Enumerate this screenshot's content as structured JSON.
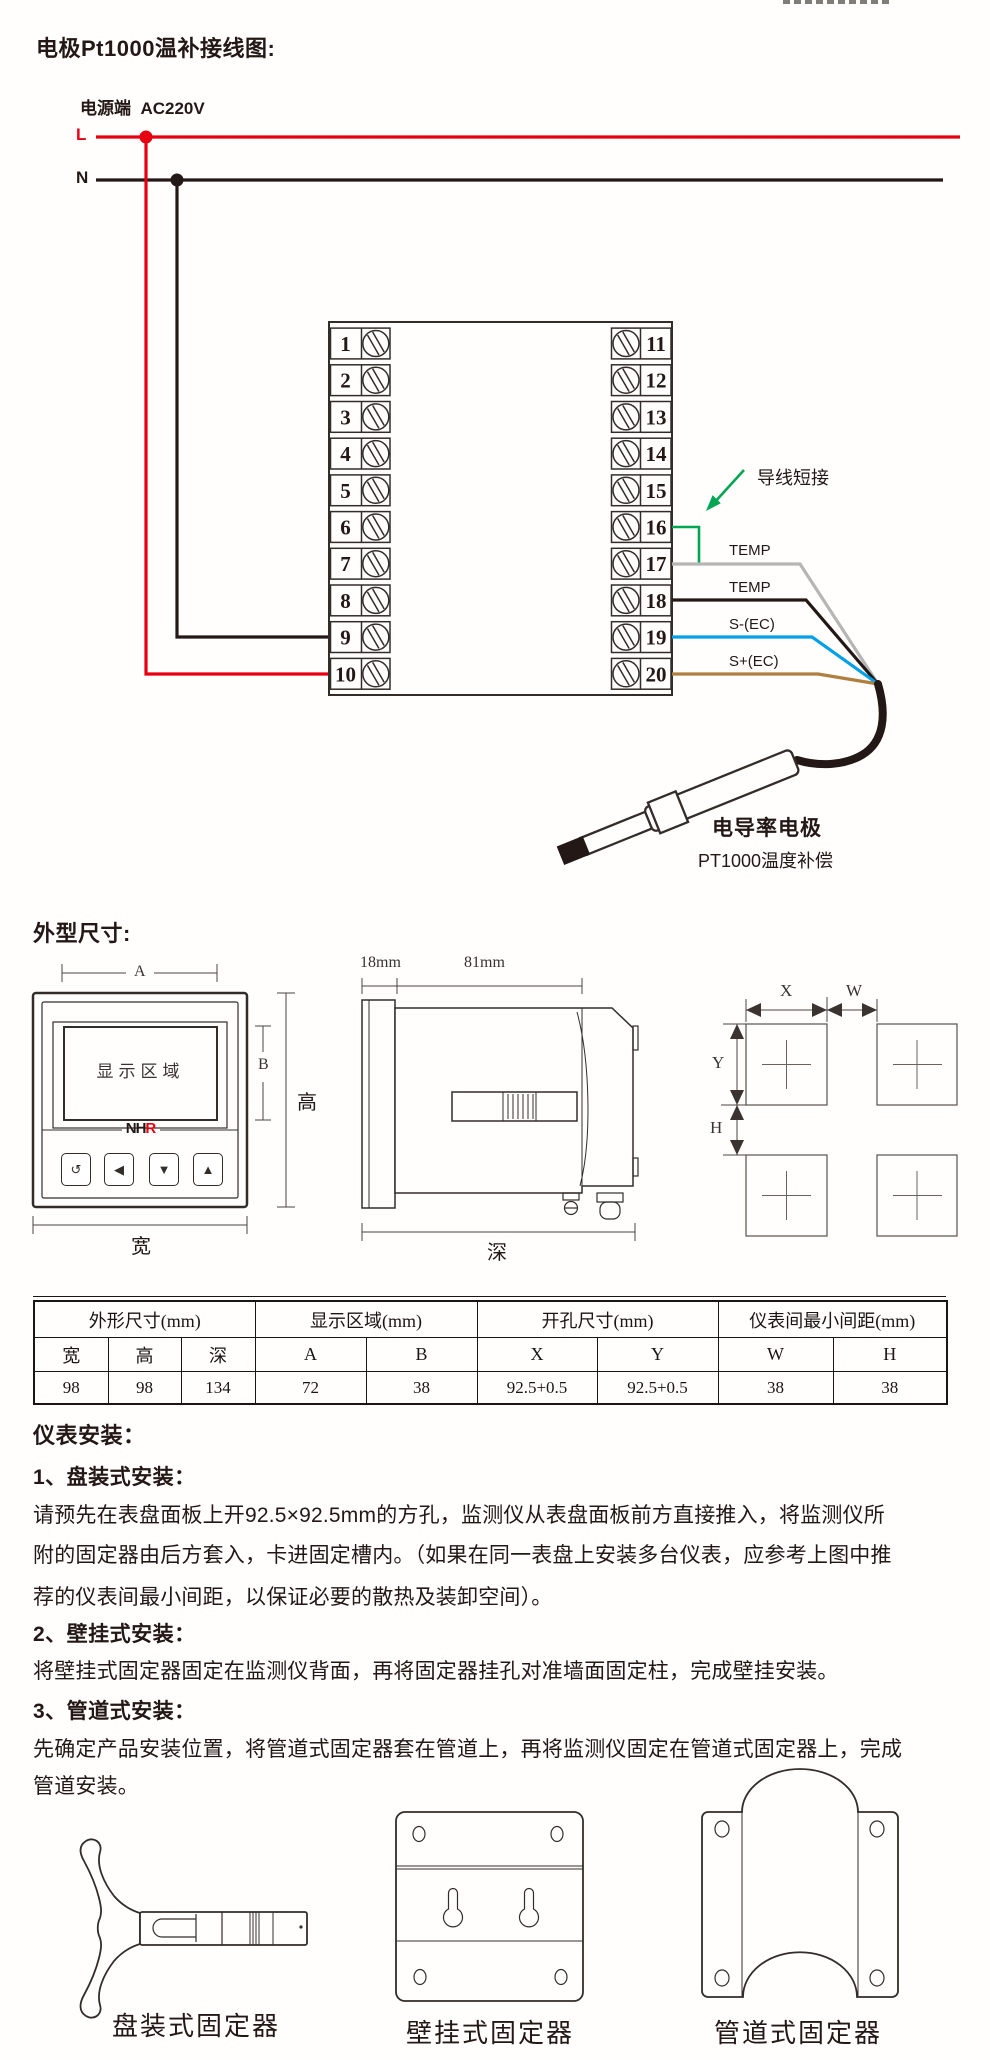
{
  "page": {
    "colors": {
      "ink": "#332d29",
      "text": "#231815",
      "logo_red": "#e60012"
    }
  },
  "wiring": {
    "title": "电极Pt1000温补接线图:",
    "power_label": "电源端  AC220V",
    "l_label": "L",
    "n_label": "N",
    "jumper_label": "导线短接",
    "wire_labels": [
      "TEMP",
      "TEMP",
      "S-(EC)",
      "S+(EC)"
    ],
    "electrode_name": "电导率电极",
    "electrode_sub": "PT1000温度补偿",
    "terminals_left": [
      "1",
      "2",
      "3",
      "4",
      "5",
      "6",
      "7",
      "8",
      "9",
      "10"
    ],
    "terminals_right": [
      "11",
      "12",
      "13",
      "14",
      "15",
      "16",
      "17",
      "18",
      "19",
      "20"
    ],
    "colors": {
      "live": "#e60012",
      "neutral": "#231815",
      "temp_a": "#b5b5b6",
      "temp_b": "#231815",
      "ec_minus": "#00a0e9",
      "ec_plus": "#b07f3f",
      "jumper": "#00a651"
    }
  },
  "dimensions": {
    "title": "外型尺寸:",
    "front": {
      "display_label": "显示区域",
      "logo": {
        "black": "NH",
        "red": "R"
      },
      "dim_a": "A",
      "dim_b": "B",
      "height_label": "高",
      "width_label": "宽",
      "buttons": [
        "↺",
        "◀",
        "▼",
        "▲"
      ]
    },
    "side": {
      "dim_18": "18mm",
      "dim_81": "81mm",
      "depth_label": "深"
    },
    "cutout": {
      "x": "X",
      "w": "W",
      "y": "Y",
      "h": "H"
    }
  },
  "spec_table": {
    "groups": [
      {
        "label": "外形尺寸(mm)",
        "span": 3
      },
      {
        "label": "显示区域(mm)",
        "span": 2
      },
      {
        "label": "开孔尺寸(mm)",
        "span": 2
      },
      {
        "label": "仪表间最小间距(mm)",
        "span": 2
      }
    ],
    "columns": [
      "宽",
      "高",
      "深",
      "A",
      "B",
      "X",
      "Y",
      "W",
      "H"
    ],
    "values": [
      "98",
      "98",
      "134",
      "72",
      "38",
      "92.5+0.5",
      "92.5+0.5",
      "38",
      "38"
    ],
    "col_widths": [
      74,
      73,
      74,
      111,
      111,
      120,
      121,
      115,
      114
    ]
  },
  "installation": {
    "title": "仪表安装：",
    "sections": [
      {
        "heading": "1、盘装式安装：",
        "lines": [
          "请预先在表盘面板上开92.5×92.5mm的方孔，监测仪从表盘面板前方直接推入，将监测仪所",
          "附的固定器由后方套入，卡进固定槽内。（如果在同一表盘上安装多台仪表，应参考上图中推",
          "荐的仪表间最小间距，以保证必要的散热及装卸空间）。"
        ]
      },
      {
        "heading": "2、壁挂式安装：",
        "lines": [
          "将壁挂式固定器固定在监测仪背面，再将固定器挂孔对准墙面固定柱，完成壁挂安装。"
        ]
      },
      {
        "heading": "3、管道式安装：",
        "lines": [
          "先确定产品安装位置，将管道式固定器套在管道上，再将监测仪固定在管道式固定器上，完成",
          "管道安装。"
        ]
      }
    ],
    "fixture_labels": [
      "盘装式固定器",
      "壁挂式固定器",
      "管道式固定器"
    ]
  }
}
